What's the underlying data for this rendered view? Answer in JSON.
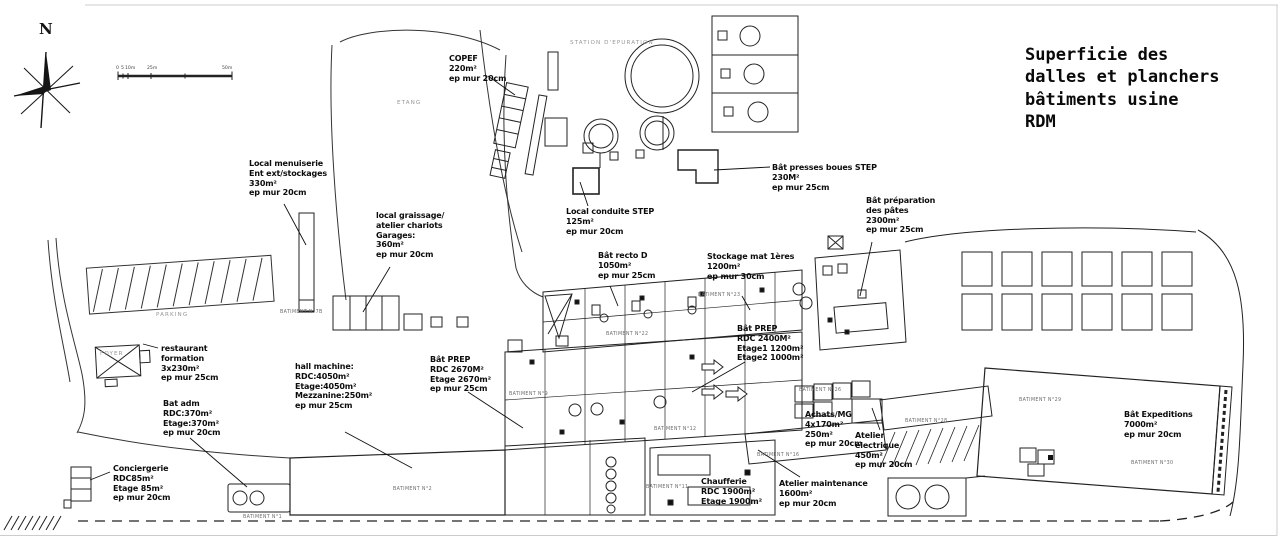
{
  "title": {
    "lines": [
      "Superficie des",
      "dalles et planchers",
      "bâtiments usine",
      "RDM"
    ]
  },
  "compass": {
    "label": "N"
  },
  "scale_bar": {
    "y": 66,
    "ticks": [
      {
        "label": "0",
        "x": 116
      },
      {
        "label": "5",
        "x": 121
      },
      {
        "label": "10m",
        "x": 125
      },
      {
        "label": "25m",
        "x": 147
      },
      {
        "label": "50m",
        "x": 222
      }
    ]
  },
  "colors": {
    "ink": "#111111",
    "line": "#2b2b2b",
    "muted": "#6d6d6d",
    "faint": "#979797",
    "frame": "#cccccc"
  },
  "plan": {
    "annotations": [
      {
        "id": "copef",
        "x": 449,
        "y": 54,
        "lines": [
          "COPEF",
          "220m²",
          "ep mur 20cm"
        ]
      },
      {
        "id": "presses-boues-step",
        "x": 772,
        "y": 163,
        "lines": [
          "Bât presses boues STEP",
          "230M²",
          "ep mur 25cm"
        ]
      },
      {
        "id": "preparation-pates",
        "x": 866,
        "y": 196,
        "lines": [
          "Bât préparation",
          "des pâtes",
          "2300m²",
          "ep mur 25cm"
        ]
      },
      {
        "id": "local-menuiserie",
        "x": 249,
        "y": 159,
        "lines": [
          "Local menuiserie",
          "Ent ext/stockages",
          "330m²",
          "ep mur 20cm"
        ]
      },
      {
        "id": "local-graissage",
        "x": 376,
        "y": 211,
        "lines": [
          "local graissage/",
          "atelier chariots",
          "Garages:",
          "360m²",
          "ep mur 20cm"
        ]
      },
      {
        "id": "local-conduite-step",
        "x": 566,
        "y": 207,
        "lines": [
          "Local conduite STEP",
          "125m²",
          "ep mur 20cm"
        ]
      },
      {
        "id": "bat-recto-d",
        "x": 598,
        "y": 251,
        "lines": [
          "Bât recto D",
          "1050m²",
          "ep mur 25cm"
        ]
      },
      {
        "id": "stockage-mat-1eres",
        "x": 707,
        "y": 252,
        "lines": [
          "Stockage mat 1ères",
          "1200m²",
          "ep mur 30cm"
        ]
      },
      {
        "id": "restaurant-formation",
        "x": 161,
        "y": 344,
        "lines": [
          "restaurant",
          "formation",
          "3x230m²",
          "ep mur 25cm"
        ]
      },
      {
        "id": "hall-machine",
        "x": 295,
        "y": 362,
        "lines": [
          "hall machine:",
          "RDC:4050m²",
          "Etage:4050m²",
          "Mezzanine:250m²",
          "ep mur 25cm"
        ]
      },
      {
        "id": "bat-prep-2670",
        "x": 430,
        "y": 355,
        "lines": [
          "Bât PREP",
          "RDC 2670M²",
          "Etage 2670m²",
          "ep mur 25cm"
        ]
      },
      {
        "id": "bat-prep-2400",
        "x": 737,
        "y": 324,
        "lines": [
          "Bât PREP",
          "RDC 2400M²",
          "Etage1 1200m²",
          "Etage2 1000m²"
        ]
      },
      {
        "id": "bat-adm",
        "x": 163,
        "y": 399,
        "lines": [
          "Bat adm",
          "RDC:370m²",
          "Etage:370m²",
          "ep mur 20cm"
        ]
      },
      {
        "id": "conciergerie",
        "x": 113,
        "y": 464,
        "lines": [
          "Conciergerie",
          "RDC85m²",
          "Etage 85m²",
          "ep mur 20cm"
        ]
      },
      {
        "id": "achats-mg",
        "x": 805,
        "y": 410,
        "lines": [
          "Achats/MG",
          "4x170m²",
          "250m²",
          "ep mur 20cm"
        ]
      },
      {
        "id": "atelier-electrique",
        "x": 855,
        "y": 431,
        "lines": [
          "Atelier",
          "electrique",
          "450m²",
          "ep mur 20cm"
        ]
      },
      {
        "id": "bat-expeditions",
        "x": 1124,
        "y": 410,
        "lines": [
          "Bât Expeditions",
          "7000m²",
          "ep mur 20cm"
        ]
      },
      {
        "id": "chaufferie",
        "x": 701,
        "y": 477,
        "lines": [
          "Chaufferie",
          "RDC 1900m²",
          "Etage 1900m²"
        ]
      },
      {
        "id": "atelier-maintenance",
        "x": 779,
        "y": 479,
        "lines": [
          "Atelier maintenance",
          "1600m²",
          "ep mur 20cm"
        ]
      }
    ],
    "site_labels": [
      {
        "id": "etang",
        "text": "ETANG",
        "x": 397,
        "y": 100
      },
      {
        "id": "parking",
        "text": "PARKING",
        "x": 156,
        "y": 312
      },
      {
        "id": "station-epuration",
        "text": "STATION D'EPURATION",
        "x": 570,
        "y": 40
      },
      {
        "id": "foyer",
        "text": "FOYER",
        "x": 100,
        "y": 351
      }
    ],
    "building_labels": [
      {
        "id": "batiment-1",
        "text": "BATIMENT N°1",
        "x": 243,
        "y": 515
      },
      {
        "id": "batiment-2",
        "text": "BATIMENT N°2",
        "x": 393,
        "y": 487
      },
      {
        "id": "batiment-7b",
        "text": "BATIMENT N°7B",
        "x": 280,
        "y": 310
      },
      {
        "id": "batiment-9",
        "text": "BATIMENT N°9",
        "x": 509,
        "y": 392
      },
      {
        "id": "batiment-11",
        "text": "BATIMENT N°11",
        "x": 646,
        "y": 485
      },
      {
        "id": "batiment-12",
        "text": "BATIMENT N°12",
        "x": 654,
        "y": 427
      },
      {
        "id": "batiment-16",
        "text": "BATIMENT N°16",
        "x": 757,
        "y": 453
      },
      {
        "id": "batiment-22",
        "text": "BATIMENT N°22",
        "x": 606,
        "y": 332
      },
      {
        "id": "batiment-23",
        "text": "BATIMENT N°23",
        "x": 698,
        "y": 293
      },
      {
        "id": "batiment-26",
        "text": "BATIMENT N°26",
        "x": 799,
        "y": 388
      },
      {
        "id": "batiment-28",
        "text": "BATIMENT N°28",
        "x": 905,
        "y": 419
      },
      {
        "id": "batiment-29",
        "text": "BATIMENT N°29",
        "x": 1019,
        "y": 398
      },
      {
        "id": "batiment-30",
        "text": "BATIMENT N°30",
        "x": 1131,
        "y": 461
      }
    ]
  }
}
